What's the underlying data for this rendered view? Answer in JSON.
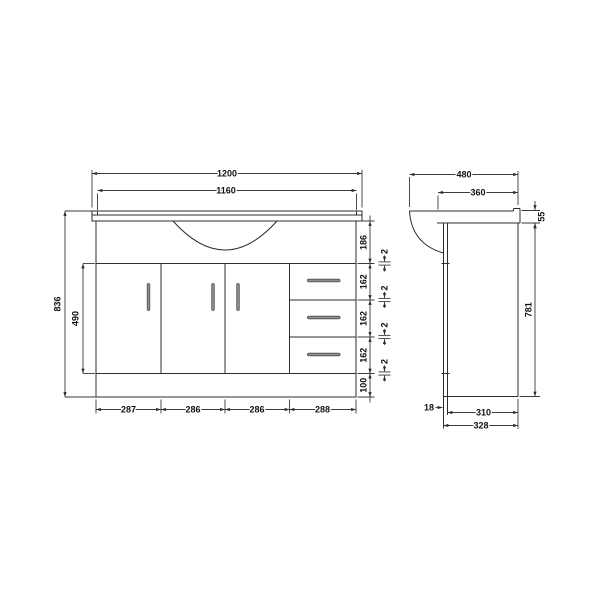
{
  "meta": {
    "description": "Technical dimension drawing of a bathroom vanity basin unit, front elevation and side elevation",
    "units": "mm"
  },
  "colors": {
    "line": "#2d2d2d",
    "text": "#111111",
    "handle_fill": "#8f8f8f",
    "handle_stroke": "#4f4f4f",
    "background": "#ffffff"
  },
  "front": {
    "top_dims": {
      "countertop_width": "1200",
      "inner_width": "1160"
    },
    "left_dims": {
      "total_height": "836",
      "door_height": "490"
    },
    "right_dims": [
      "186",
      "2",
      "162",
      "2",
      "162",
      "2",
      "162",
      "2",
      "100"
    ],
    "bottom_dims": [
      "287",
      "286",
      "286",
      "288"
    ]
  },
  "side": {
    "top_dims": {
      "overall_depth": "480",
      "worktop_depth": "360"
    },
    "right_dims": {
      "worktop_height": "55",
      "cabinet_height": "781"
    },
    "bottom_dims": {
      "panel_thickness": "18",
      "recess_depth": "310",
      "base_depth": "328"
    }
  }
}
